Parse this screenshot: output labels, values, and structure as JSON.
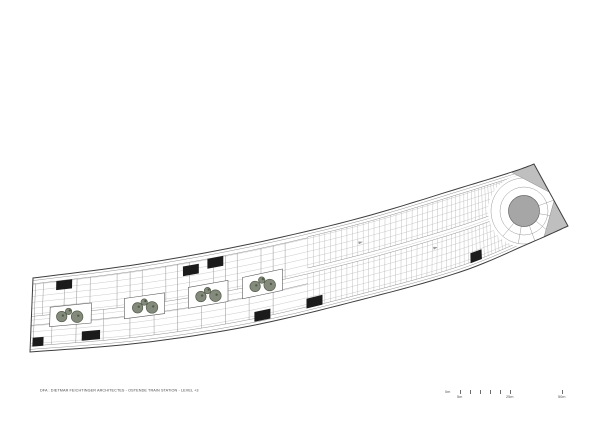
{
  "caption": {
    "text": "DFA : DIETMAR FEICHTINGER ARCHITECTES - OSTENDE TRAIN STATION - LEVEL +3"
  },
  "scale_bar": {
    "zero_label": "0m",
    "tick_label_1": "5m",
    "tick_label_2": "25m",
    "tick_label_3": "50m"
  },
  "plan": {
    "colors": {
      "outline": "#3e3e3e",
      "line_light": "#c4c4c4",
      "line_mid": "#8f8f8f",
      "deck_line": "#b2b2b2",
      "tree_fill": "#6f7766",
      "tree_stroke": "#535c49",
      "core_fill": "#1b1b1b",
      "gray_fill": "#bfbfbf",
      "ramp_fill": "#a6a6a6",
      "white": "#ffffff"
    },
    "band": {
      "top": [
        [
          33,
          278
        ],
        [
          140,
          264
        ],
        [
          250,
          244
        ],
        [
          360,
          218
        ],
        [
          460,
          188
        ],
        [
          515,
          171
        ],
        [
          534,
          164
        ]
      ],
      "bottom": [
        [
          30,
          352
        ],
        [
          140,
          343
        ],
        [
          250,
          326
        ],
        [
          360,
          300
        ],
        [
          460,
          272
        ],
        [
          530,
          243
        ],
        [
          568,
          226
        ]
      ]
    },
    "longitudinal_t": [
      0.09,
      0.17,
      0.25,
      0.33,
      0.41,
      0.49,
      0.57,
      0.65,
      0.73,
      0.81,
      0.89
    ],
    "edge_inset_t": [
      0.035,
      0.965
    ],
    "corridor_t": [
      0.52,
      0.64
    ],
    "partitions": {
      "start": 0.008,
      "end": 0.4,
      "step": 0.018,
      "t_top": 0.08,
      "t_mid": 0.52,
      "t_bot": 0.92
    },
    "room_zone": {
      "s_end": 0.42,
      "t_lines": [
        0.08,
        0.92
      ]
    },
    "deck": {
      "start": 0.42,
      "end": 0.955,
      "step": 0.0085,
      "bands": [
        [
          0.07,
          0.45
        ],
        [
          0.52,
          0.93
        ]
      ],
      "lane_t": [
        0.07,
        0.45,
        0.52,
        0.93
      ]
    },
    "planters": [
      {
        "s": 0.07,
        "t": 0.55
      },
      {
        "s": 0.174,
        "t": 0.54
      },
      {
        "s": 0.27,
        "t": 0.52
      },
      {
        "s": 0.352,
        "t": 0.52
      }
    ],
    "planter_half": {
      "ds": 0.03,
      "dt": 0.13
    },
    "cores": [
      {
        "s": 0.018,
        "t": 0.87
      },
      {
        "s": 0.061,
        "t": 0.14
      },
      {
        "s": 0.1,
        "t": 0.84
      },
      {
        "s": 0.244,
        "t": 0.18
      },
      {
        "s": 0.281,
        "t": 0.14
      },
      {
        "s": 0.352,
        "t": 0.9
      },
      {
        "s": 0.43,
        "t": 0.88
      },
      {
        "s": 0.7,
        "t": 0.88
      }
    ],
    "core_half": {
      "ds": 0.012,
      "dt": 0.06
    },
    "arrows": [
      {
        "s": 0.5,
        "t": 0.3
      },
      {
        "s": 0.62,
        "t": 0.62
      },
      {
        "s": 0.75,
        "t": 0.33
      },
      {
        "s": 0.87,
        "t": 0.62
      }
    ],
    "ramp": {
      "cx": 524,
      "cy": 211,
      "r": 15.5,
      "mask_r": 36,
      "rings": [
        24,
        33
      ],
      "spoke_angles_deg": [
        -20,
        10,
        40,
        70,
        100,
        130
      ],
      "spoke_r0": 16,
      "spoke_r1": 33
    },
    "cap_triangles": [
      [
        [
          534,
          164
        ],
        [
          549,
          192
        ],
        [
          511,
          172
        ]
      ],
      [
        [
          568,
          226
        ],
        [
          554,
          201
        ],
        [
          544,
          237
        ]
      ]
    ]
  }
}
